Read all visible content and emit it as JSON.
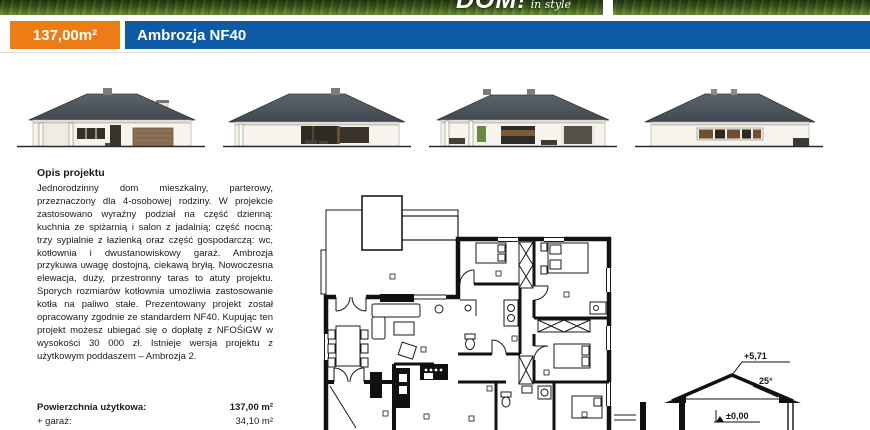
{
  "banner": {
    "logo_text": "DOM!",
    "logo_suffix": "in style"
  },
  "header": {
    "area_badge": "137,00m²",
    "title": "Ambrozja NF40",
    "accent_orange": "#ee7c16",
    "accent_blue": "#0d5aa7"
  },
  "description": {
    "heading": "Opis projektu",
    "body": "Jednorodzinny dom mieszkalny, parterowy, przeznaczony dla 4-osobowej rodziny. W projekcie zastosowano wyraźny podział na część dzienną: kuchnia ze spiżarnią i salon z jadalnią; część nocną: trzy sypialnie z łazienką oraz część gospodarczą: wc, kotłownia i dwustanowiskowy garaż. Ambrozja przykuwa uwagę dostojną, ciekawą bryłą. Nowoczesna elewacja, duży, przestronny taras to atuty projektu. Sporych rozmiarów kotłownia umożliwia zastosowanie kotła na paliwo stałe. Prezentowany projekt został opracowany zgodnie ze standardem NF40. Kupując ten projekt możesz ubiegać się o dopłatę z NFOŚiGW w wysokości 30 000 zł. Istnieje wersja projektu z użytkowym poddaszem – Ambrozja 2."
  },
  "areas": {
    "rows": [
      {
        "label": "Powierzchnia użytkowa:",
        "value": "137,00 m²"
      },
      {
        "label": "+ garaż:",
        "value": "34,10 m²"
      }
    ]
  },
  "section_drawing": {
    "ridge_level": "+5,71",
    "roof_angle": "25°",
    "zero_level": "±0,00"
  }
}
